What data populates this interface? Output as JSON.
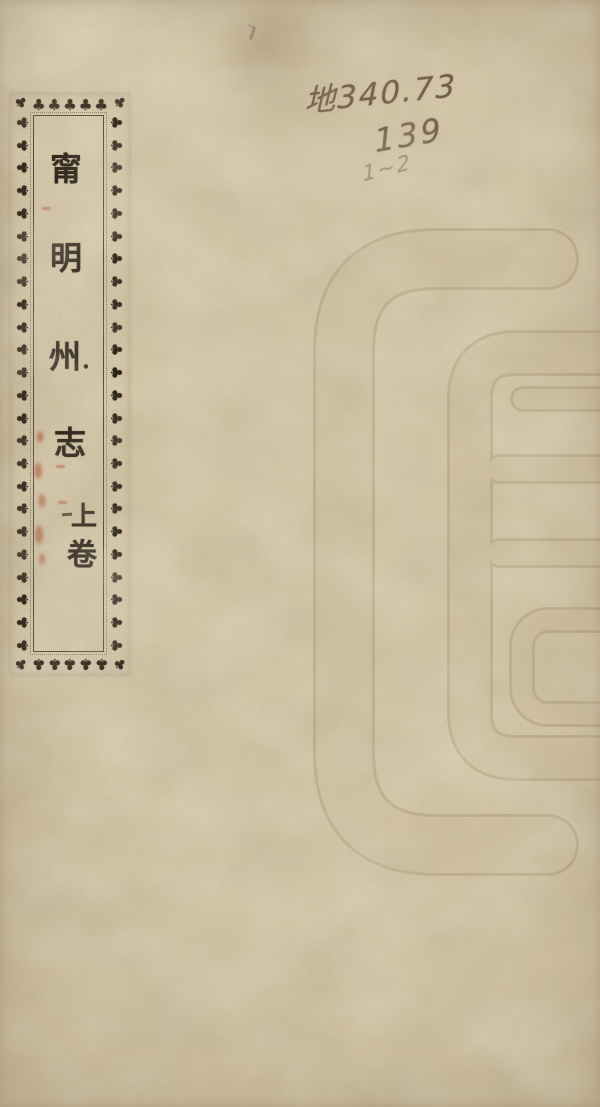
{
  "document": {
    "label": {
      "title": "甯明州志",
      "title_chars": [
        "甯",
        "明",
        "州",
        "志"
      ],
      "separator_dot": "·",
      "volume": "上卷",
      "volume_chars": [
        "上",
        "卷"
      ],
      "border_ornament": "♣",
      "corner_ornament": "♣"
    },
    "handwritten_call_number": {
      "line1": "地340.73",
      "line2": "139",
      "line3": "1~2"
    },
    "watermark": {
      "name": "library-watermark-glyph"
    },
    "colors": {
      "paper": "#d6c9ab",
      "label_paper": "#d7caae",
      "ink": "#2a2219",
      "ornament_ink": "#241d12",
      "pencil": "#6f5c49",
      "red_seal": "#b04a2c",
      "watermark_line": "#a3946f"
    }
  }
}
